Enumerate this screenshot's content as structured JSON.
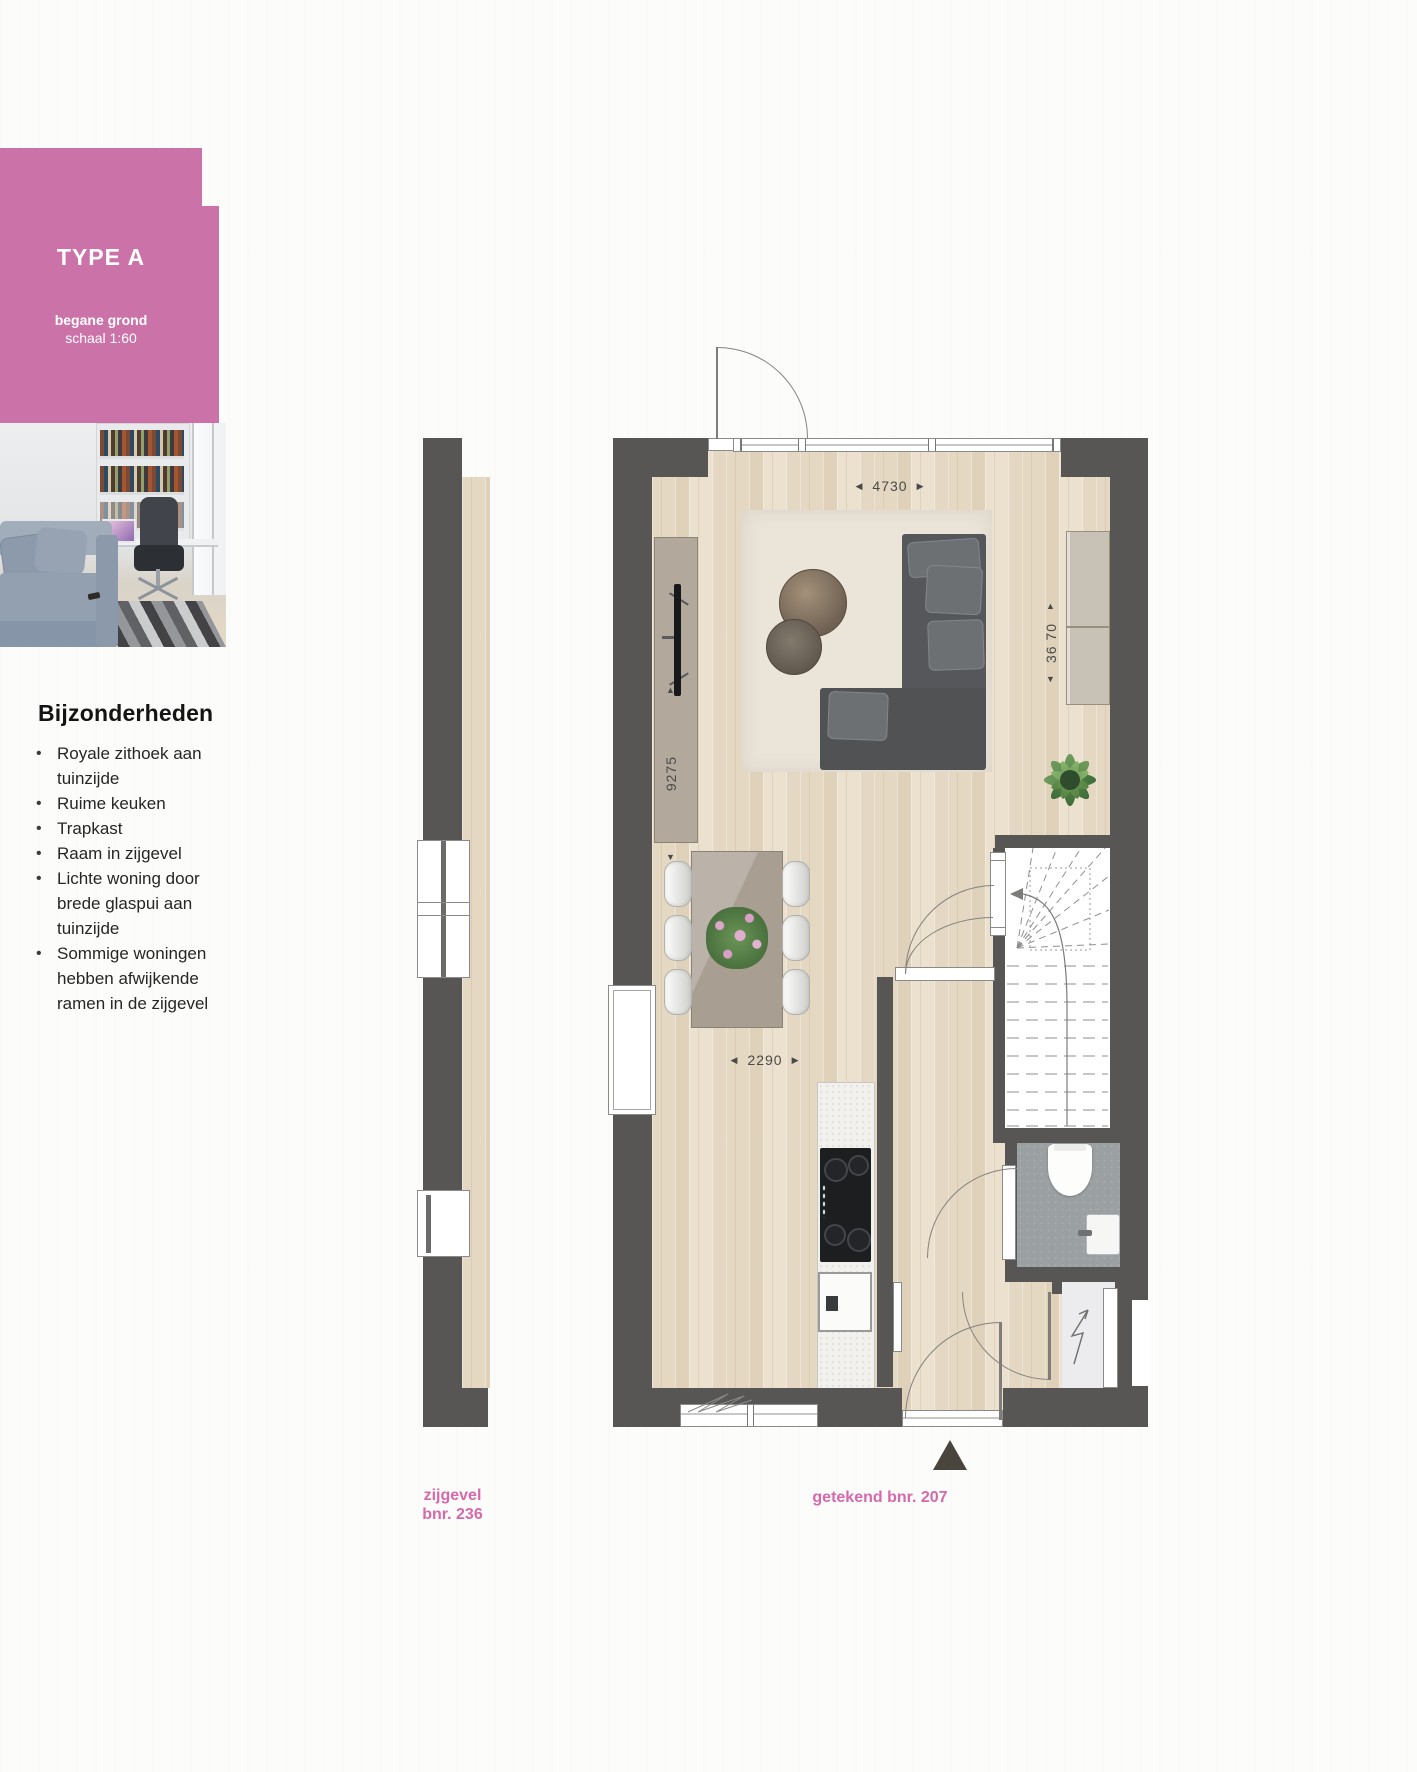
{
  "badge": {
    "title": "TYPE A",
    "subtitle_bold": "begane grond",
    "subtitle": "schaal 1:60"
  },
  "features": {
    "heading": "Bijzonderheden",
    "bullets": [
      "Royale zithoek aan tuinzijde",
      "Ruime keuken",
      "Trapkast",
      "Raam in zijgevel",
      "Lichte woning door brede glaspui aan tuinzijde",
      "Sommige woningen hebben afwijkende ramen in de zijgevel"
    ]
  },
  "dimensions": {
    "top_width": "4730",
    "room_depth": "9275",
    "kitchen_width": "2290",
    "right_height": "36 70"
  },
  "labels": {
    "side_facade": "zijgevel",
    "side_facade_bnr": "bnr. 236",
    "drawn_bnr": "getekend bnr. 207"
  },
  "icons": {
    "bullet": "•",
    "arrow_left": "◀",
    "arrow_right": "▶",
    "arrow_up": "▲",
    "arrow_down": "▼"
  },
  "colors": {
    "accent_pink": "#cb73a8",
    "label_pink": "#d569ab",
    "wall_dark": "#575655",
    "floor_wood": "#e8ddc9",
    "tile_gray": "#9ba0a2"
  }
}
